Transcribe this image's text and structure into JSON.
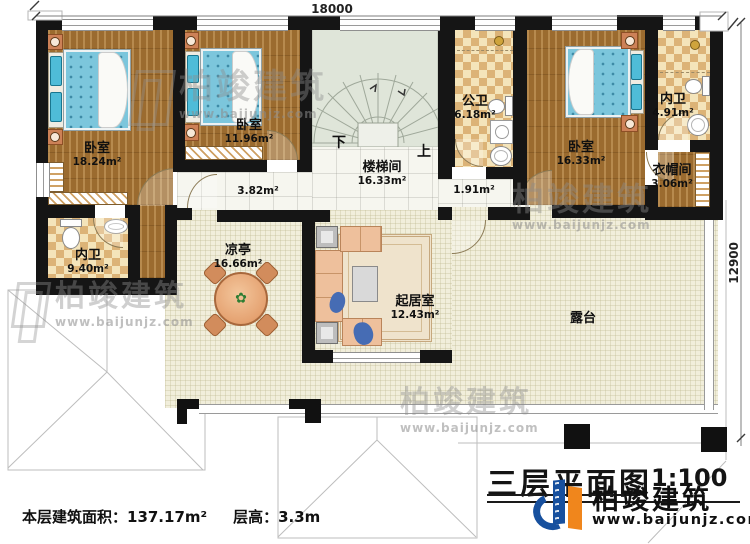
{
  "plan": {
    "dim_top": "18000",
    "dim_right": "12900",
    "stair_down": "下",
    "stair_up": "上",
    "rooms": {
      "bedroom1": {
        "name": "卧室",
        "area": "18.24m²"
      },
      "bedroom2": {
        "name": "卧室",
        "area": "11.96m²"
      },
      "bedroom3": {
        "name": "卧室",
        "area": "16.33m²"
      },
      "stair_hall": {
        "name": "楼梯间",
        "area": "16.33m²"
      },
      "public_bath": {
        "name": "公卫",
        "area": "6.18m²"
      },
      "master_bath": {
        "name": "内卫",
        "area": "4.91m²"
      },
      "closet": {
        "name": "衣帽间",
        "area": "3.06m²"
      },
      "en_suite": {
        "name": "内卫",
        "area": "9.40m²"
      },
      "pavilion": {
        "name": "凉亭",
        "area": "16.66m²"
      },
      "living": {
        "name": "起居室",
        "area": "12.43m²"
      },
      "terrace": {
        "name": "露台"
      },
      "hall_a": {
        "area": "3.82m²"
      },
      "hall_b": {
        "area": "1.91m²"
      }
    },
    "notes": {
      "floor_area": "本层建筑面积：137.17m²",
      "floor_height": "层高：3.3m"
    },
    "titleblock": {
      "title": "三层平面图",
      "scale": "1:100"
    },
    "brand": {
      "name": "柏竣建筑",
      "url": "www.baijunjz.com"
    }
  }
}
